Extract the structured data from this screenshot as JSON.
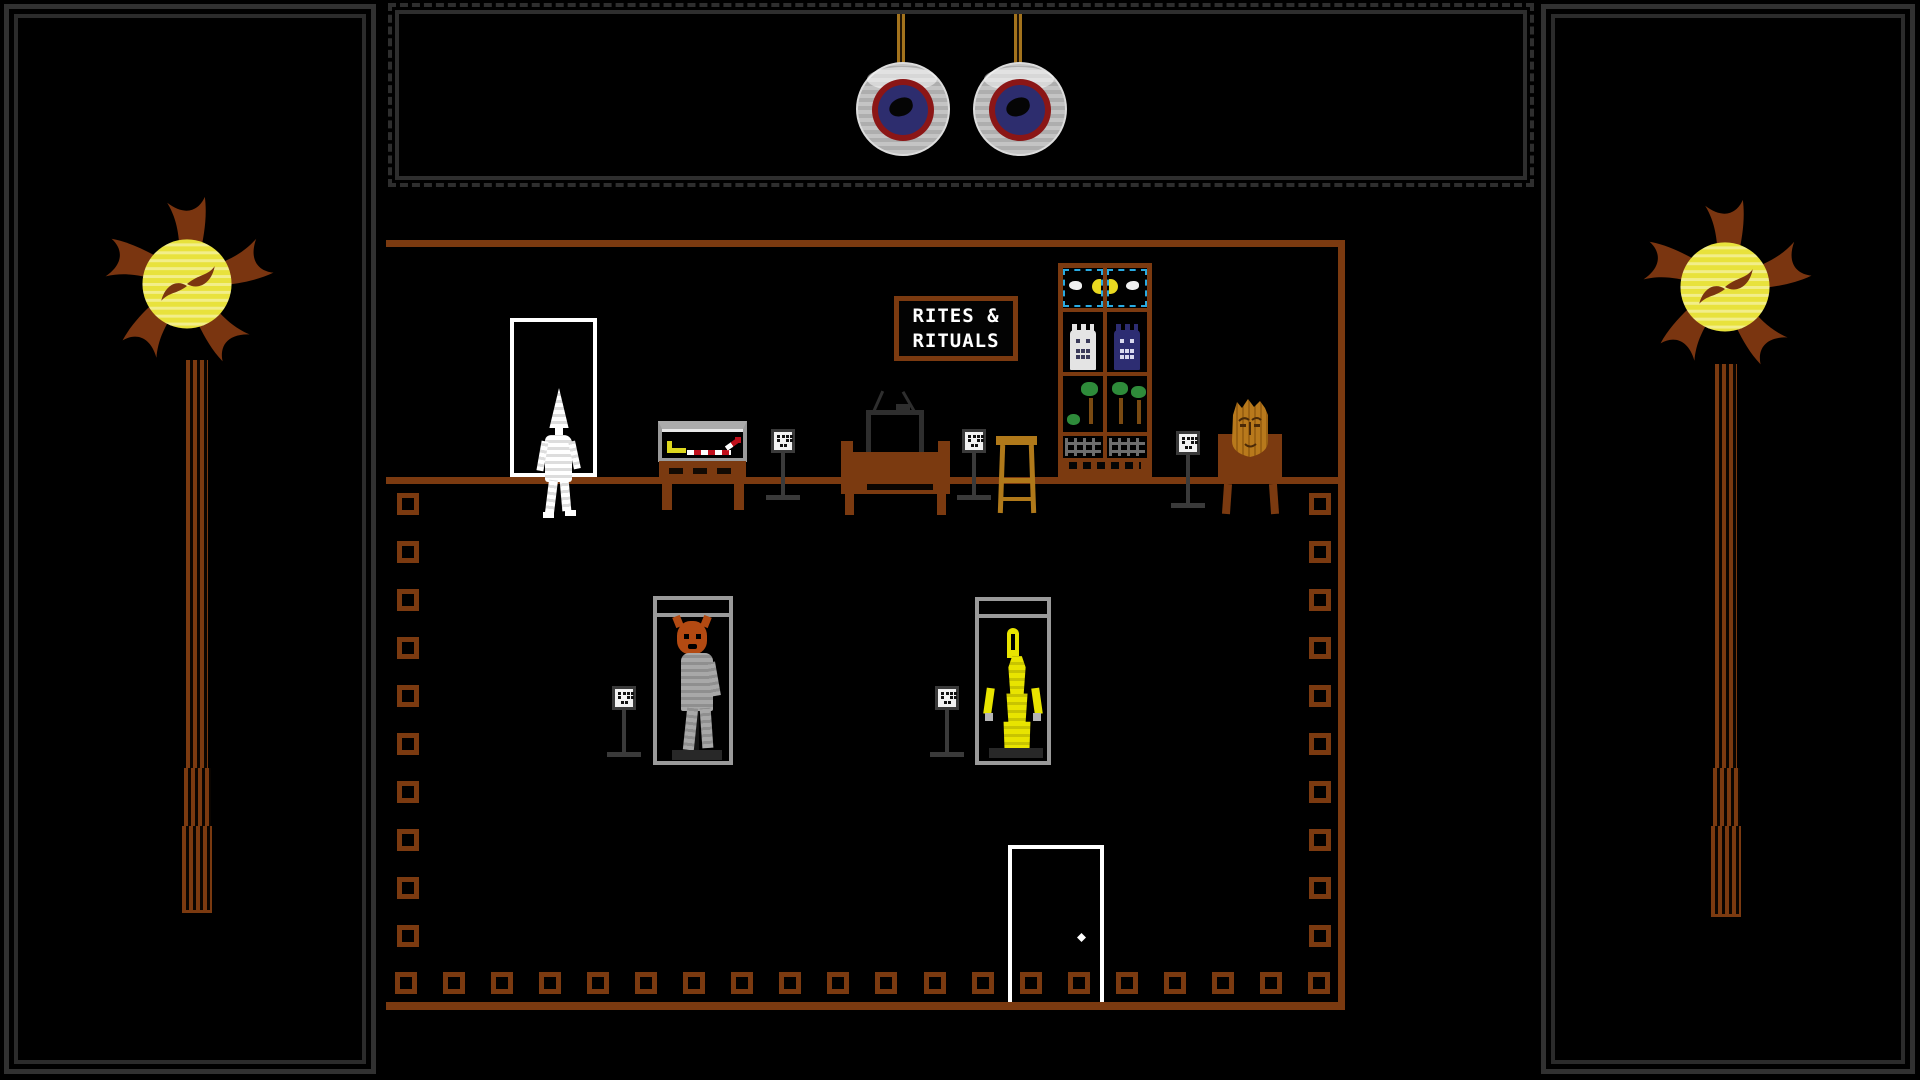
{
  "scene": {
    "name": "rites-and-rituals-shop",
    "sign": {
      "line1": "RITES &",
      "line2": "RITUALS"
    }
  },
  "colors": {
    "wood": "#7b3a10",
    "wood_light": "#b0791a",
    "rope": "#a3731d",
    "flame_petal": "#7a3510",
    "flame_core": "#e8e23c",
    "flame_core_light": "#f2ee8a",
    "frame_gray": "#2e2e2e",
    "case_gray": "#9a9a9a",
    "eye_ring_red": "#8b1616",
    "eye_iris": "#2d2d6e",
    "accent_blue": "#29abe2",
    "figure_yellow": "#e8e400",
    "figure_gray": "#9d9d9d",
    "mask_orange": "#b34a12",
    "head_gold": "#b8791c",
    "tree_green": "#2e8b3a",
    "trunk_brown": "#7a4a12",
    "fence_gray": "#6e6e6e",
    "wand_red": "#c0101c",
    "door_white": "#ffffff",
    "placard_gray": "#3a3a3a"
  },
  "object_names": [
    "hanging-eyeball",
    "wall-torch",
    "shop-sign",
    "back-doorway",
    "white-mannequin",
    "artifact-display-case",
    "exhibit-placard",
    "television",
    "wooden-stool",
    "curio-cabinet",
    "carved-head-bust",
    "masked-mannequin-case",
    "golden-idol-case",
    "exit-door",
    "floor-tile"
  ],
  "tile_counts": {
    "left_column": 10,
    "right_column": 10,
    "bottom_row": 20
  }
}
